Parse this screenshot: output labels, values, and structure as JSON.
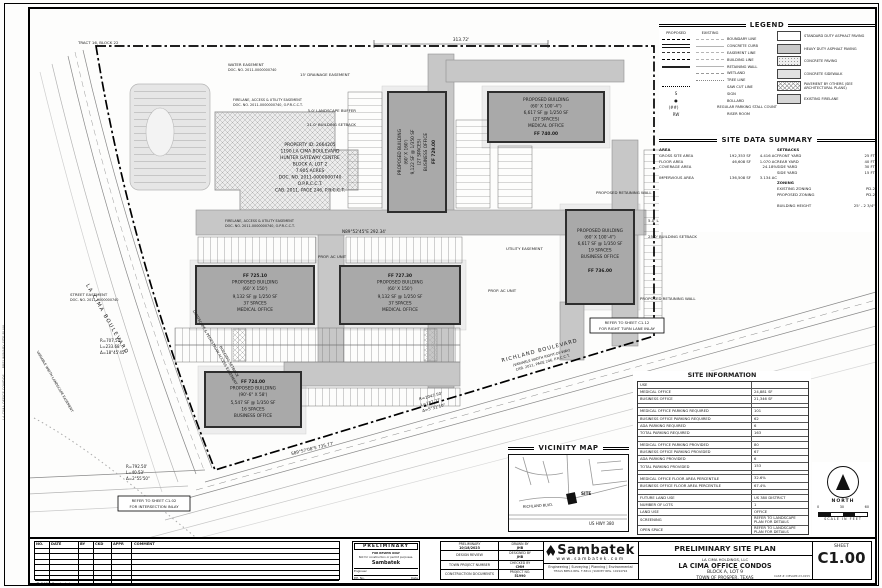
{
  "sheet": {
    "number": "C1.00",
    "sheet_label": "SHEET",
    "copyright": "© 2023 Sambatek",
    "side_text": "LA CIMA OFFICE CONDOS — PRELIMINARY SITE PLAN"
  },
  "legend": {
    "title": "LEGEND",
    "proposed_header": "PROPOSED",
    "existing_header": "EXISTING",
    "line_items": [
      "BOUNDARY LINE",
      "CONCRETE CURB",
      "EASEMENT LINE",
      "BUILDING LINE",
      "RETAINING WALL",
      "WETLAND",
      "TREE LINE",
      "SAW CUT LINE"
    ],
    "symbol_items": [
      {
        "symbol": "S",
        "label": "SIGN"
      },
      {
        "symbol": "●",
        "label": "BOLLARD"
      },
      {
        "symbol": "(##)",
        "label": "REGULAR PARKING STALL COUNT"
      },
      {
        "symbol": "RW",
        "label": "RISER ROOM"
      }
    ],
    "paving_items": [
      "STANDARD DUTY ASPHALT PAVING",
      "HEAVY DUTY ASPHALT PAVING",
      "CONCRETE PAVING",
      "CONCRETE SIDEWALK",
      "PAVEMENT BY OTHERS (SEE ARCHITECTURAL PLANS)",
      "EXISTING FIRELANE"
    ]
  },
  "site_data": {
    "title": "SITE DATA SUMMARY",
    "area_header": "AREA",
    "area_rows": [
      {
        "label": "GROSS SITE AREA",
        "sf": "192,353 SF",
        "ac": "4.416 AC"
      },
      {
        "label": "FLOOR AREA",
        "sf": "46,608 SF",
        "ac": "1.070 AC"
      },
      {
        "label": "COVERAGE AREA",
        "sf": "",
        "ac": "24.18%"
      },
      {
        "label": "IMPERVIOUS AREA",
        "sf": "136,508 SF",
        "ac": "3.134 AC"
      }
    ],
    "setbacks_header": "SETBACKS",
    "setback_rows": [
      {
        "label": "FRONT YARD",
        "value": "25 FT"
      },
      {
        "label": "REAR YARD",
        "value": "40 FT"
      },
      {
        "label": "SIDE YARD",
        "value": "30 FT"
      },
      {
        "label": "SIDE YARD",
        "value": "15 FT"
      }
    ],
    "zoning_header": "ZONING",
    "zoning_rows": [
      {
        "label": "EXISTING ZONING",
        "value": "PD-2"
      },
      {
        "label": "PROPOSED ZONING",
        "value": "PD-2"
      }
    ],
    "height_label": "BUILDING HEIGHT",
    "height_value": "25' - 2 3/4\""
  },
  "site_info": {
    "title": "SITE INFORMATION",
    "rows": [
      {
        "label": "USE",
        "value": ""
      },
      {
        "label": "MEDICAL OFFICE",
        "value": "24,881 SF"
      },
      {
        "label": "BUSINESS OFFICE",
        "value": "21,346 SF"
      },
      {
        "label": "",
        "value": ""
      },
      {
        "label": "MEDICAL OFFICE PARKING REQUIRED",
        "value": "101"
      },
      {
        "label": "BUSINESS OFFICE PARKING REQUIRED",
        "value": "62"
      },
      {
        "label": "ADA PARKING REQUIRED",
        "value": "6"
      },
      {
        "label": "TOTAL PARKING REQUIRED",
        "value": "163"
      },
      {
        "label": "",
        "value": ""
      },
      {
        "label": "MEDICAL OFFICE PARKING PROVIDED",
        "value": "80"
      },
      {
        "label": "BUSINESS OFFICE PARKING PROVIDED",
        "value": "67"
      },
      {
        "label": "ADA PARKING PROVIDED",
        "value": "6"
      },
      {
        "label": "TOTAL PARKING PROVIDED",
        "value": "153"
      },
      {
        "label": "",
        "value": ""
      },
      {
        "label": "MEDICAL OFFICE FLOOR AREA PERCENTILE",
        "value": "32.6%"
      },
      {
        "label": "BUSINESS OFFICE FLOOR AREA PERCENTILE",
        "value": "67.4%"
      },
      {
        "label": "",
        "value": ""
      },
      {
        "label": "FUTURE LAND USE",
        "value": "US 380 DISTRICT"
      },
      {
        "label": "NUMBER OF LOTS",
        "value": "1"
      },
      {
        "label": "LAND USE",
        "value": "OFFICE"
      },
      {
        "label": "SCREENING",
        "value": "REFER TO LANDSCAPE PLAN FOR DETAILS"
      },
      {
        "label": "OPEN SPACE",
        "value": "REFER TO LANDSCAPE PLAN FOR DETAILS"
      }
    ]
  },
  "vicinity": {
    "title": "VICINITY MAP",
    "site": "SITE",
    "hwy": "US HWY 380",
    "richland": "RICHLAND BLVD."
  },
  "north": {
    "label": "NORTH",
    "t0": "0",
    "t30": "30",
    "t60": "60",
    "caption": "SCALE IN FEET"
  },
  "plan": {
    "buildings": {
      "b1": {
        "lines": [
          "PROPOSED BUILDING",
          "(60' X 160')",
          "9,122 SF @ 1/350 SF",
          "(27 SPACES)",
          "BUSINESS OFFICE",
          "FF 729.00"
        ]
      },
      "b2": {
        "lines": [
          "PROPOSED BUILDING",
          "(60' X 100'-4\")",
          "6,617 SF @ 1/250 SF",
          "(27 SPACES)",
          "MEDICAL OFFICE",
          "FF 740.00"
        ]
      },
      "b3": {
        "lines": [
          "FF 725.10",
          "PROPOSED BUILDING",
          "(60' X 150')",
          "9,132 SF @ 1/250 SF",
          "37 SPACES",
          "MEDICAL OFFICE"
        ]
      },
      "b4": {
        "lines": [
          "FF 727.30",
          "PROPOSED BUILDING",
          "(60' X 150')",
          "9,132 SF @ 1/250 SF",
          "37 SPACES",
          "MEDICAL OFFICE"
        ]
      },
      "b5": {
        "lines": [
          "PROPOSED BUILDING",
          "(60' X 100'-4\")",
          "6,617 SF @ 1/350 SF",
          "19 SPACES",
          "BUSINESS OFFICE",
          "FF 736.00"
        ]
      },
      "b6": {
        "lines": [
          "FF 724.00",
          "PROPOSED BUILDING",
          "(90'-6\" X 58')",
          "5,547 SF @ 1/350 SF",
          "16 SPACES",
          "BUSINESS OFFICE"
        ]
      }
    },
    "property": {
      "lines": [
        "PROPERTY ID: 2664205",
        "1190 LA CIMA BOULEVARD",
        "HUNTER GATEWAY CENTRE",
        "BLOCK A, LOT 2",
        "7.905 ACRES",
        "DOC. NO. 2011-0000000740",
        "O.P.R.C.C.T.",
        "CAB. 2011, PAGE 246, P.R.C.C.T."
      ]
    },
    "roads": {
      "richland": "RICHLAND BOULEVARD",
      "richland_row": "(VARIABLE WIDTH RIGHT-OF-WAY)",
      "richland_doc": "CAB. 2011, PAGE 246, P.R.C.C.T.",
      "lacima": "LA CIMA BOULEVARD"
    },
    "bearings": {
      "top_dim": "313.72'",
      "north_line": "N89°52'45\"E  292.34'",
      "south_line": "S89°57'08\"E  735.77'",
      "curve1": [
        "R=707.50'",
        "L=233.68'",
        "Δ=18°45'45\""
      ],
      "curve2": [
        "R=792.50'",
        "L=40.53'",
        "Δ=2°55'50\""
      ],
      "curve3": [
        "R=1047.50'",
        "L=187.77'",
        "Δ=5°31'10\""
      ]
    },
    "callouts": {
      "tract": "TRACT 16, BLOCK 22",
      "water1": "WATER EASEMENT",
      "water2": "DOC. NO. 2011-0000000740",
      "drainage": "15' DRAINAGE EASEMENT",
      "firelane1": "FIRELANE, ACCESS & UTILITY EASEMENT",
      "firelane2": "DOC. NO. 2011-0000000740, O.P.R.C.C.T.",
      "buffer5": "5.0' LANDSCAPE BUFFER",
      "setback21": "21.0' BUILDING SETBACK",
      "setback25": "25.0' BUILDING SETBACK",
      "retwall": "PROPOSED RETAINING WALL",
      "acunit": "PROP. AC UNIT",
      "utility": "UTILITY EASEMENT",
      "pedaccess": "LANDSCAPE & PEDESTRIAN ACCESS EASEMENT",
      "setback_rot": "BUILDING SETBACK",
      "street1": "STREET EASEMENT",
      "street2": "DOC. NO. 2011-0000000740",
      "varls": "VARIABLE WIDTH LANDSCAPE EASEMENT"
    },
    "notes": {
      "inlay1a": "REFER TO SHEET C1.02",
      "inlay1b": "FOR INTERSECTION INLAY",
      "inlay2a": "REFER TO SHEET C1.12",
      "inlay2b": "FOR RIGHT TURN LANE INLAY"
    }
  },
  "titleblock": {
    "stamp": {
      "title": "PRELIMINARY",
      "line1": "FOR REVIEW ONLY",
      "line2": "Not for construction or permit purposes.",
      "brand": "Sambatek",
      "engineer_label": "Engineer",
      "pe_label": "P.E. No.",
      "date_label": "Date"
    },
    "status_rows": [
      {
        "label": "PRELIMINARY",
        "value": "10/18/2023"
      },
      {
        "label": "DESIGN REVIEW",
        "value": ""
      },
      {
        "label": "TOWN PROJECT NUMBER",
        "value": ""
      },
      {
        "label": "CONSTRUCTION DOCUMENTS",
        "value": ""
      }
    ],
    "credit_rows": [
      {
        "label": "DRAWN BY",
        "value": "JHB"
      },
      {
        "label": "DESIGNED BY",
        "value": "JHB"
      },
      {
        "label": "CHECKED BY",
        "value": "CMM"
      },
      {
        "label": "PROJECT NO.",
        "value": "51990"
      }
    ],
    "brand": {
      "name": "Sambatek",
      "url": "www.sambatek.com",
      "services": "Engineering | Surveying | Planning | Environmental",
      "reg": "TEXAS BPELS REG. F-5814 | SURVEY REG. 10194794"
    },
    "title": {
      "sheet_title": "PRELIMINARY SITE PLAN",
      "owner": "LA CIMA HOLDINGS, LLC",
      "project": "LA CIMA OFFICE CONDOS",
      "lot": "BLOCK A, LOT 9",
      "city": "TOWN OF PROSPER, TEXAS",
      "case_no": "CASE #: DEVAPP-23-0155"
    }
  },
  "revisions": {
    "headers": [
      "NO.",
      "DATE",
      "BY",
      "CKD",
      "APPR",
      "COMMENT"
    ]
  }
}
